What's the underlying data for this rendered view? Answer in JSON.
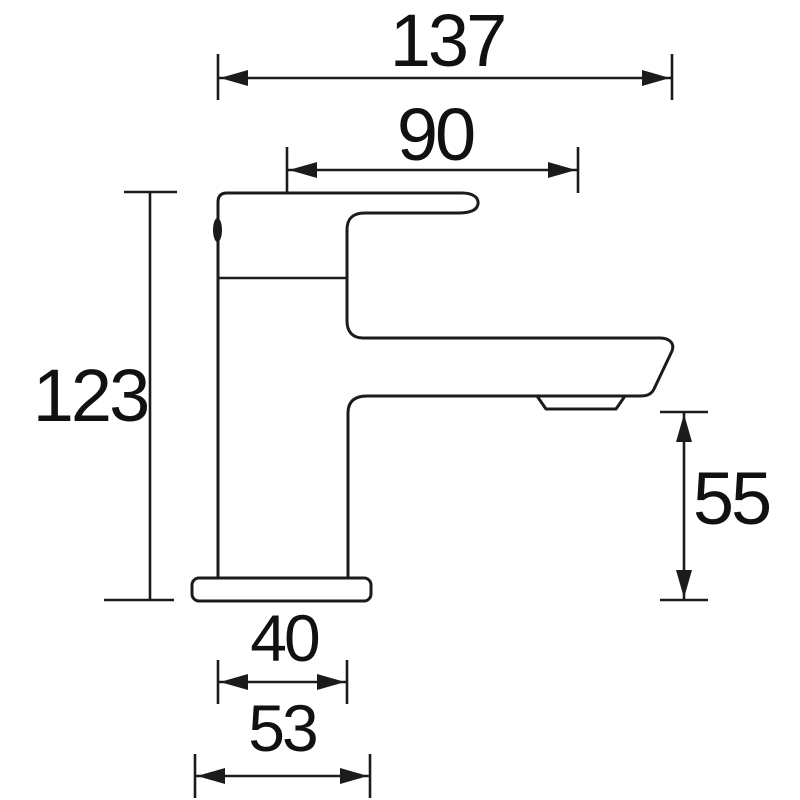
{
  "diagram": {
    "kind": "technical-dimension-drawing",
    "subject": "basin-mixer-tap-side-elevation",
    "background_color": "#ffffff",
    "line_color": "#1b1b1b",
    "text_color": "#111111",
    "dims": {
      "overall_depth": "137",
      "spout_reach": "90",
      "overall_height": "123",
      "spout_height": "55",
      "body_width": "40",
      "base_width": "53"
    }
  }
}
